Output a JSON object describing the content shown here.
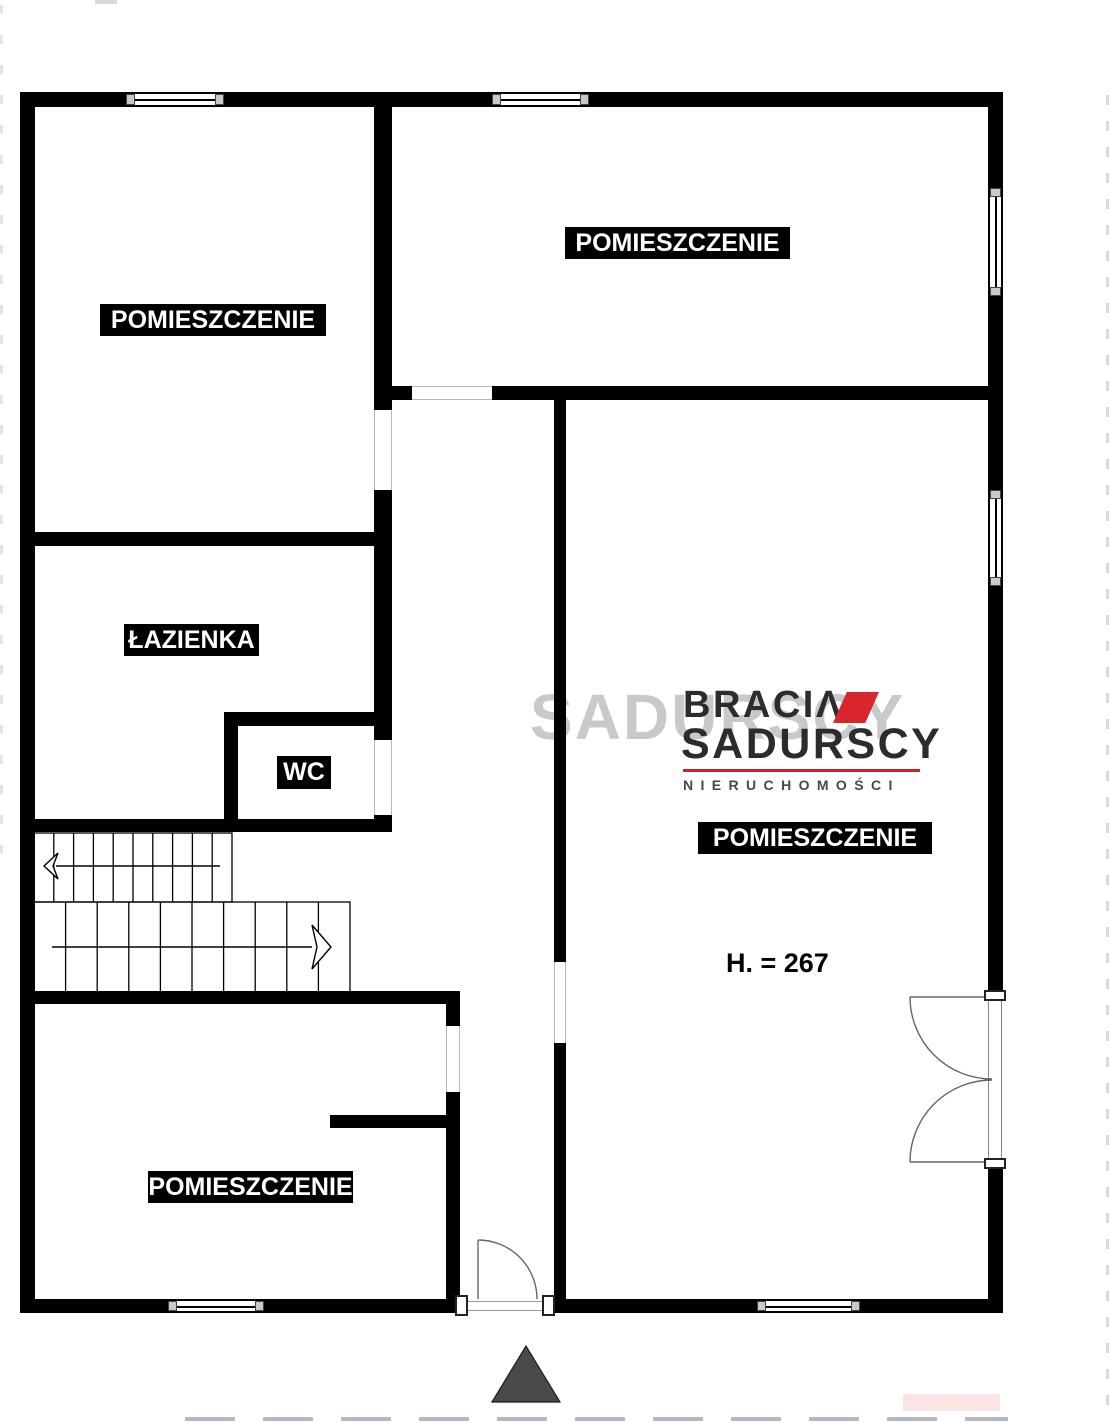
{
  "plan": {
    "rooms": [
      {
        "id": "room-top-left",
        "label": "POMIESZCZENIE"
      },
      {
        "id": "room-top-right",
        "label": "POMIESZCZENIE"
      },
      {
        "id": "room-main",
        "label": "POMIESZCZENIE"
      },
      {
        "id": "room-bottom-left",
        "label": "POMIESZCZENIE"
      },
      {
        "id": "bathroom",
        "label": "ŁAZIENKA"
      },
      {
        "id": "wc",
        "label": "WC"
      }
    ],
    "height_note": "H. = 267"
  },
  "logo": {
    "line1": "BRACIΛ",
    "line2": "SADURSCY",
    "line3": "NIERUCHOMOŚCI"
  },
  "watermark": "SADURSCY",
  "colors": {
    "wall": "#000000",
    "label_bg": "#000000",
    "label_text": "#ffffff",
    "logo_dark": "#2b2b30",
    "logo_red": "#d8262c",
    "triangle": "#4a4a4a"
  }
}
